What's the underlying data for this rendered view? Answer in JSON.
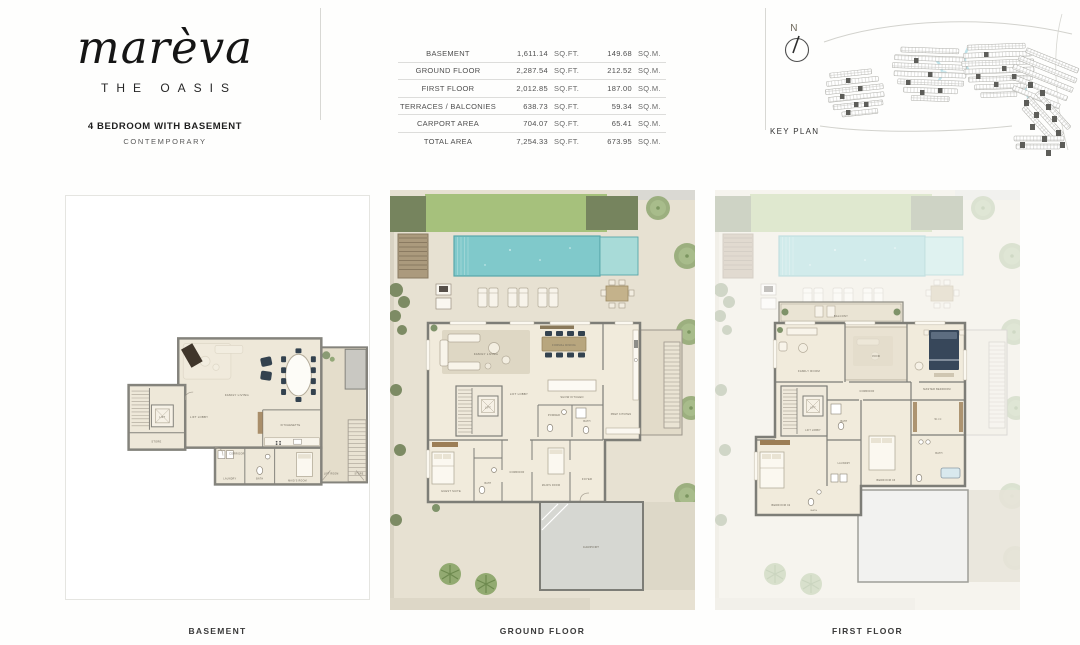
{
  "brand": {
    "logo_script": "marèva",
    "logo_subtitle": "THE OASIS"
  },
  "unit": {
    "title": "4 BEDROOM WITH BASEMENT",
    "style": "CONTEMPORARY"
  },
  "area_table": {
    "rows": [
      {
        "label": "BASEMENT",
        "sqft": "1,611.14",
        "sqft_unit": "SQ.FT.",
        "sqm": "149.68",
        "sqm_unit": "SQ.M."
      },
      {
        "label": "GROUND FLOOR",
        "sqft": "2,287.54",
        "sqft_unit": "SQ.FT.",
        "sqm": "212.52",
        "sqm_unit": "SQ.M."
      },
      {
        "label": "FIRST FLOOR",
        "sqft": "2,012.85",
        "sqft_unit": "SQ.FT.",
        "sqm": "187.00",
        "sqm_unit": "SQ.M."
      },
      {
        "label": "TERRACES / BALCONIES",
        "sqft": "638.73",
        "sqft_unit": "SQ.FT.",
        "sqm": "59.34",
        "sqm_unit": "SQ.M."
      },
      {
        "label": "CARPORT AREA",
        "sqft": "704.07",
        "sqft_unit": "SQ.FT.",
        "sqm": "65.41",
        "sqm_unit": "SQ.M."
      },
      {
        "label": "TOTAL AREA",
        "sqft": "7,254.33",
        "sqft_unit": "SQ.FT.",
        "sqm": "673.95",
        "sqm_unit": "SQ.M."
      }
    ]
  },
  "keyplan": {
    "compass_label": "N",
    "caption": "KEY PLAN"
  },
  "plans": {
    "basement": {
      "caption": "BASEMENT",
      "rooms": {
        "family": "FAMILY LIVING",
        "lobby": "LIFT LOBBY",
        "lift": "LIFT",
        "store": "STORE",
        "kitchenette": "KITCHENETTE",
        "corridor": "CORRIDOR",
        "laundry": "LAUNDRY",
        "bath": "BATH",
        "maid": "MAID'S ROOM",
        "liftroom": "LIFT ROOM",
        "store2": "STORE"
      }
    },
    "ground": {
      "caption": "GROUND FLOOR",
      "rooms": {
        "living": "FAMILY LIVING",
        "dining": "FORMAL DINING",
        "show_kitchen": "SHOW KITCHEN",
        "prep_kitchen": "PREP KITCHEN",
        "lobby": "LIFT LOBBY",
        "lift": "LIFT",
        "powder": "POWDER",
        "bath": "BATH",
        "guest": "GUEST SUITE",
        "corridor": "CORRIDOR",
        "maid": "MAID'S ROOM",
        "foyer": "FOYER",
        "carport": "CARPORT"
      }
    },
    "first": {
      "caption": "FIRST FLOOR",
      "rooms": {
        "balcony": "BALCONY",
        "family": "FAMILY ROOM",
        "void": "VOID",
        "master": "MASTER BEDROOM",
        "wic": "W.I.C",
        "master_bath": "BATH",
        "bed3": "BEDROOM 03",
        "bed2": "BEDROOM 02",
        "bath3": "BATH",
        "laundry": "LAUNDRY",
        "bath2": "BATH",
        "lobby": "LIFT LOBBY",
        "lift": "LIFT",
        "corridor": "CORRIDOR"
      }
    }
  },
  "colors": {
    "pool": "#7fc9cb",
    "lawn": "#a6c17c",
    "wall": "#7d7d77",
    "chair_navy": "#33424f",
    "highlight_plot": "#5d5d59"
  }
}
